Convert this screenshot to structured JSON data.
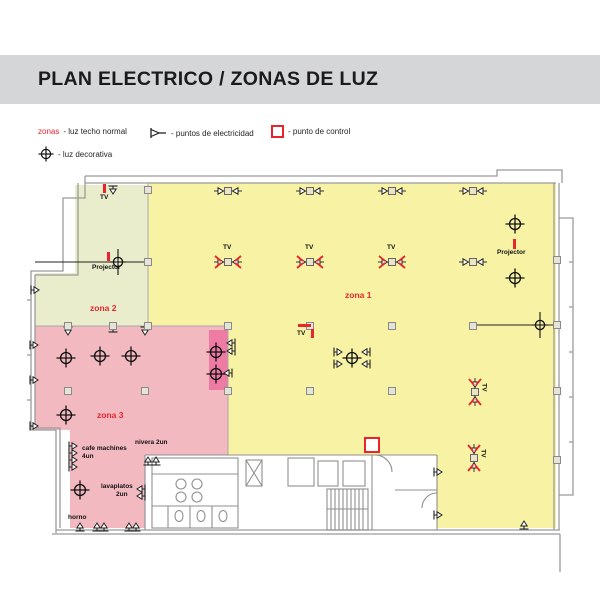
{
  "title": "PLAN ELECTRICO / ZONAS DE LUZ",
  "legend": {
    "zones_label": "zonas",
    "zones_desc": "- luz techo normal",
    "deco_desc": "- luz decorativa",
    "electric_desc": "- puntos de electricidad",
    "control_desc": "- punto de control"
  },
  "colors": {
    "band": "#d5d6d8",
    "red": "#e8252b",
    "zone1": "#f8f3a4",
    "zone2": "#e9edcb",
    "zone3": "#f3b9c1",
    "zone3dark": "#ee7ba3",
    "wall": "#9b9b9b",
    "colfill": "#e6e4d6"
  },
  "zones": [
    {
      "id": "zona1",
      "label": "zona 1"
    },
    {
      "id": "zona2",
      "label": "zona 2"
    },
    {
      "id": "zona3",
      "label": "zona 3"
    }
  ],
  "plan": {
    "labels": [
      {
        "text": "TV",
        "x": 100,
        "y": 195,
        "cls": "small"
      },
      {
        "text": "Projector",
        "x": 92,
        "y": 265,
        "cls": "small"
      },
      {
        "text": "Projector",
        "x": 497,
        "y": 250,
        "cls": "small"
      },
      {
        "text": "TV",
        "x": 297,
        "y": 331,
        "cls": "small"
      },
      {
        "text": "zona 1",
        "x": 345,
        "y": 291,
        "cls": "zone"
      },
      {
        "text": "zona 2",
        "x": 90,
        "y": 304,
        "cls": "zone"
      },
      {
        "text": "zona 3",
        "x": 97,
        "y": 411,
        "cls": "zone"
      },
      {
        "text": "cafe machines",
        "x": 82,
        "y": 446,
        "cls": "small"
      },
      {
        "text": "4un",
        "x": 82,
        "y": 454,
        "cls": "small"
      },
      {
        "text": "nivera 2un",
        "x": 135,
        "y": 440,
        "cls": "small"
      },
      {
        "text": "lavaplatos",
        "x": 101,
        "y": 484,
        "cls": "small"
      },
      {
        "text": "2un",
        "x": 116,
        "y": 492,
        "cls": "small"
      },
      {
        "text": "horno",
        "x": 68,
        "y": 515,
        "cls": "small"
      }
    ],
    "symbols": {
      "dual_points": [
        {
          "x": 228,
          "y": 191
        },
        {
          "x": 310,
          "y": 191
        },
        {
          "x": 392,
          "y": 191
        },
        {
          "x": 473,
          "y": 191
        },
        {
          "x": 473,
          "y": 262
        }
      ],
      "tv_points": [
        {
          "x": 228,
          "y": 262,
          "label": "TV"
        },
        {
          "x": 310,
          "y": 262,
          "label": "TV"
        },
        {
          "x": 392,
          "y": 262,
          "label": "TV"
        },
        {
          "x": 475,
          "y": 392,
          "label": "TV",
          "rot": 90
        },
        {
          "x": 474,
          "y": 458,
          "label": "TV",
          "rot": 90
        }
      ],
      "deco_lights": [
        {
          "x": 515,
          "y": 224
        },
        {
          "x": 515,
          "y": 278
        },
        {
          "x": 66,
          "y": 358
        },
        {
          "x": 100,
          "y": 356
        },
        {
          "x": 131,
          "y": 356
        },
        {
          "x": 216,
          "y": 352
        },
        {
          "x": 216,
          "y": 374
        },
        {
          "x": 66,
          "y": 415
        },
        {
          "x": 80,
          "y": 490
        },
        {
          "x": 352,
          "y": 358
        }
      ],
      "line_lights": [
        {
          "x": 118,
          "y": 262
        },
        {
          "x": 540,
          "y": 325
        }
      ],
      "wall_points": [
        {
          "x": 113,
          "y": 190,
          "dir": "down"
        },
        {
          "x": 35,
          "y": 290,
          "dir": "right"
        },
        {
          "x": 34,
          "y": 345,
          "dir": "right"
        },
        {
          "x": 34,
          "y": 380,
          "dir": "right"
        },
        {
          "x": 34,
          "y": 426,
          "dir": "right"
        },
        {
          "x": 68,
          "y": 331,
          "dir": "down"
        },
        {
          "x": 113,
          "y": 328,
          "dir": "up"
        },
        {
          "x": 145,
          "y": 331,
          "dir": "down"
        },
        {
          "x": 231,
          "y": 343,
          "dir": "left"
        },
        {
          "x": 231,
          "y": 351,
          "dir": "left"
        },
        {
          "x": 228,
          "y": 373,
          "dir": "left"
        },
        {
          "x": 338,
          "y": 352,
          "dir": "right"
        },
        {
          "x": 338,
          "y": 364,
          "dir": "right"
        },
        {
          "x": 366,
          "y": 352,
          "dir": "left"
        },
        {
          "x": 366,
          "y": 364,
          "dir": "left"
        },
        {
          "x": 73,
          "y": 446,
          "dir": "right"
        },
        {
          "x": 73,
          "y": 453,
          "dir": "right"
        },
        {
          "x": 73,
          "y": 460,
          "dir": "right"
        },
        {
          "x": 73,
          "y": 467,
          "dir": "right"
        },
        {
          "x": 148,
          "y": 461,
          "dir": "up"
        },
        {
          "x": 156,
          "y": 461,
          "dir": "up"
        },
        {
          "x": 141,
          "y": 489,
          "dir": "left"
        },
        {
          "x": 141,
          "y": 496,
          "dir": "left"
        },
        {
          "x": 80,
          "y": 527,
          "dir": "up"
        },
        {
          "x": 97,
          "y": 527,
          "dir": "up"
        },
        {
          "x": 104,
          "y": 527,
          "dir": "up"
        },
        {
          "x": 129,
          "y": 527,
          "dir": "up"
        },
        {
          "x": 136,
          "y": 527,
          "dir": "up"
        },
        {
          "x": 438,
          "y": 472,
          "dir": "right"
        },
        {
          "x": 438,
          "y": 515,
          "dir": "right"
        },
        {
          "x": 524,
          "y": 525,
          "dir": "up"
        }
      ],
      "columns": [
        {
          "x": 148,
          "y": 190
        },
        {
          "x": 148,
          "y": 262
        },
        {
          "x": 68,
          "y": 326
        },
        {
          "x": 113,
          "y": 326
        },
        {
          "x": 148,
          "y": 326
        },
        {
          "x": 228,
          "y": 326
        },
        {
          "x": 310,
          "y": 326
        },
        {
          "x": 392,
          "y": 326
        },
        {
          "x": 473,
          "y": 326
        },
        {
          "x": 557,
          "y": 325
        },
        {
          "x": 68,
          "y": 391
        },
        {
          "x": 145,
          "y": 391
        },
        {
          "x": 228,
          "y": 391
        },
        {
          "x": 310,
          "y": 391
        },
        {
          "x": 392,
          "y": 391
        },
        {
          "x": 557,
          "y": 391
        },
        {
          "x": 557,
          "y": 260
        },
        {
          "x": 557,
          "y": 460
        }
      ],
      "control_point": {
        "x": 372,
        "y": 445
      },
      "red_ticks": [
        {
          "x": 103,
          "y": 184,
          "w": 3,
          "h": 9
        },
        {
          "x": 107,
          "y": 252,
          "w": 3,
          "h": 9
        },
        {
          "x": 513,
          "y": 239,
          "w": 3,
          "h": 10
        },
        {
          "x": 298,
          "y": 324,
          "w": 13,
          "h": 3
        },
        {
          "x": 311,
          "y": 329,
          "w": 3,
          "h": 9
        }
      ]
    }
  }
}
